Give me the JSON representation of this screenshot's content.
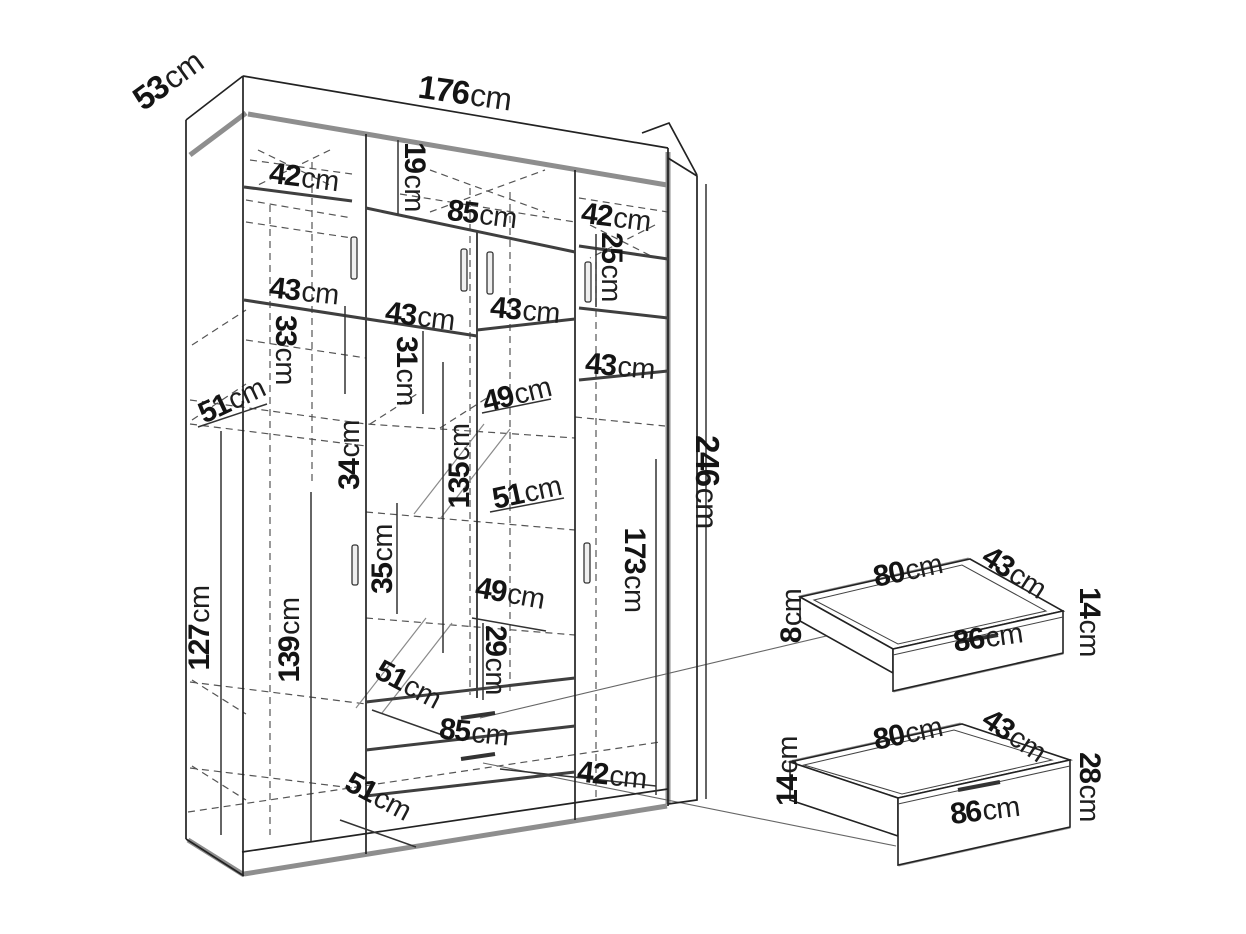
{
  "figure": {
    "type": "furniture-dimension-diagram",
    "subject": "four-door wardrobe with interior shelving and two pull-out drawers",
    "unit": "cm",
    "colors": {
      "background": "#ffffff",
      "line": "#222222",
      "heavy_line": "#3f3f3f",
      "shadow": "#8e8e8e",
      "dashed": "#555555",
      "text": "#141414"
    }
  },
  "wardrobe": {
    "dims": {
      "depth_top": {
        "v": "53",
        "u": "cm"
      },
      "width_total": {
        "v": "176",
        "u": "cm"
      },
      "top_left_door_w": {
        "v": "42",
        "u": "cm"
      },
      "top_gap_h": {
        "v": "19",
        "u": "cm"
      },
      "top_mid_doors_w": {
        "v": "85",
        "u": "cm"
      },
      "top_right_door_w": {
        "v": "42",
        "u": "cm"
      },
      "top_right_h": {
        "v": "25",
        "u": "cm"
      },
      "shelf_left_w": {
        "v": "43",
        "u": "cm"
      },
      "shelf_mid_w": {
        "v": "43",
        "u": "cm"
      },
      "shelf_mid_right_w": {
        "v": "43",
        "u": "cm"
      },
      "left_sec_h": {
        "v": "33",
        "u": "cm"
      },
      "mid_sec_h": {
        "v": "31",
        "u": "cm"
      },
      "right_door_w": {
        "v": "43",
        "u": "cm"
      },
      "depth_upper_left": {
        "v": "51",
        "u": "cm"
      },
      "depth_upper_mid": {
        "v": "49",
        "u": "cm"
      },
      "mid_upper_h": {
        "v": "34",
        "u": "cm"
      },
      "mirror_h": {
        "v": "135",
        "u": "cm"
      },
      "depth_mid": {
        "v": "51",
        "u": "cm"
      },
      "mid_lower_h": {
        "v": "35",
        "u": "cm"
      },
      "depth_lower_mid": {
        "v": "49",
        "u": "cm"
      },
      "right_shelf_h": {
        "v": "29",
        "u": "cm"
      },
      "left_inner_h": {
        "v": "127",
        "u": "cm"
      },
      "mid_inner_h": {
        "v": "139",
        "u": "cm"
      },
      "depth_lower_left": {
        "v": "51",
        "u": "cm"
      },
      "drawer_front_w": {
        "v": "85",
        "u": "cm"
      },
      "depth_bottom": {
        "v": "51",
        "u": "cm"
      },
      "bottom_right_w": {
        "v": "42",
        "u": "cm"
      },
      "height_total": {
        "v": "246",
        "u": "cm"
      },
      "right_sec_h": {
        "v": "173",
        "u": "cm"
      }
    }
  },
  "drawer_small": {
    "dims": {
      "width_top": {
        "v": "80",
        "u": "cm"
      },
      "depth": {
        "v": "43",
        "u": "cm"
      },
      "side_h": {
        "v": "8",
        "u": "cm"
      },
      "front_h": {
        "v": "14",
        "u": "cm"
      },
      "front_w": {
        "v": "86",
        "u": "cm"
      }
    }
  },
  "drawer_large": {
    "dims": {
      "width_top": {
        "v": "80",
        "u": "cm"
      },
      "depth": {
        "v": "43",
        "u": "cm"
      },
      "side_h": {
        "v": "14",
        "u": "cm"
      },
      "front_h": {
        "v": "28",
        "u": "cm"
      },
      "front_w": {
        "v": "86",
        "u": "cm"
      }
    }
  }
}
